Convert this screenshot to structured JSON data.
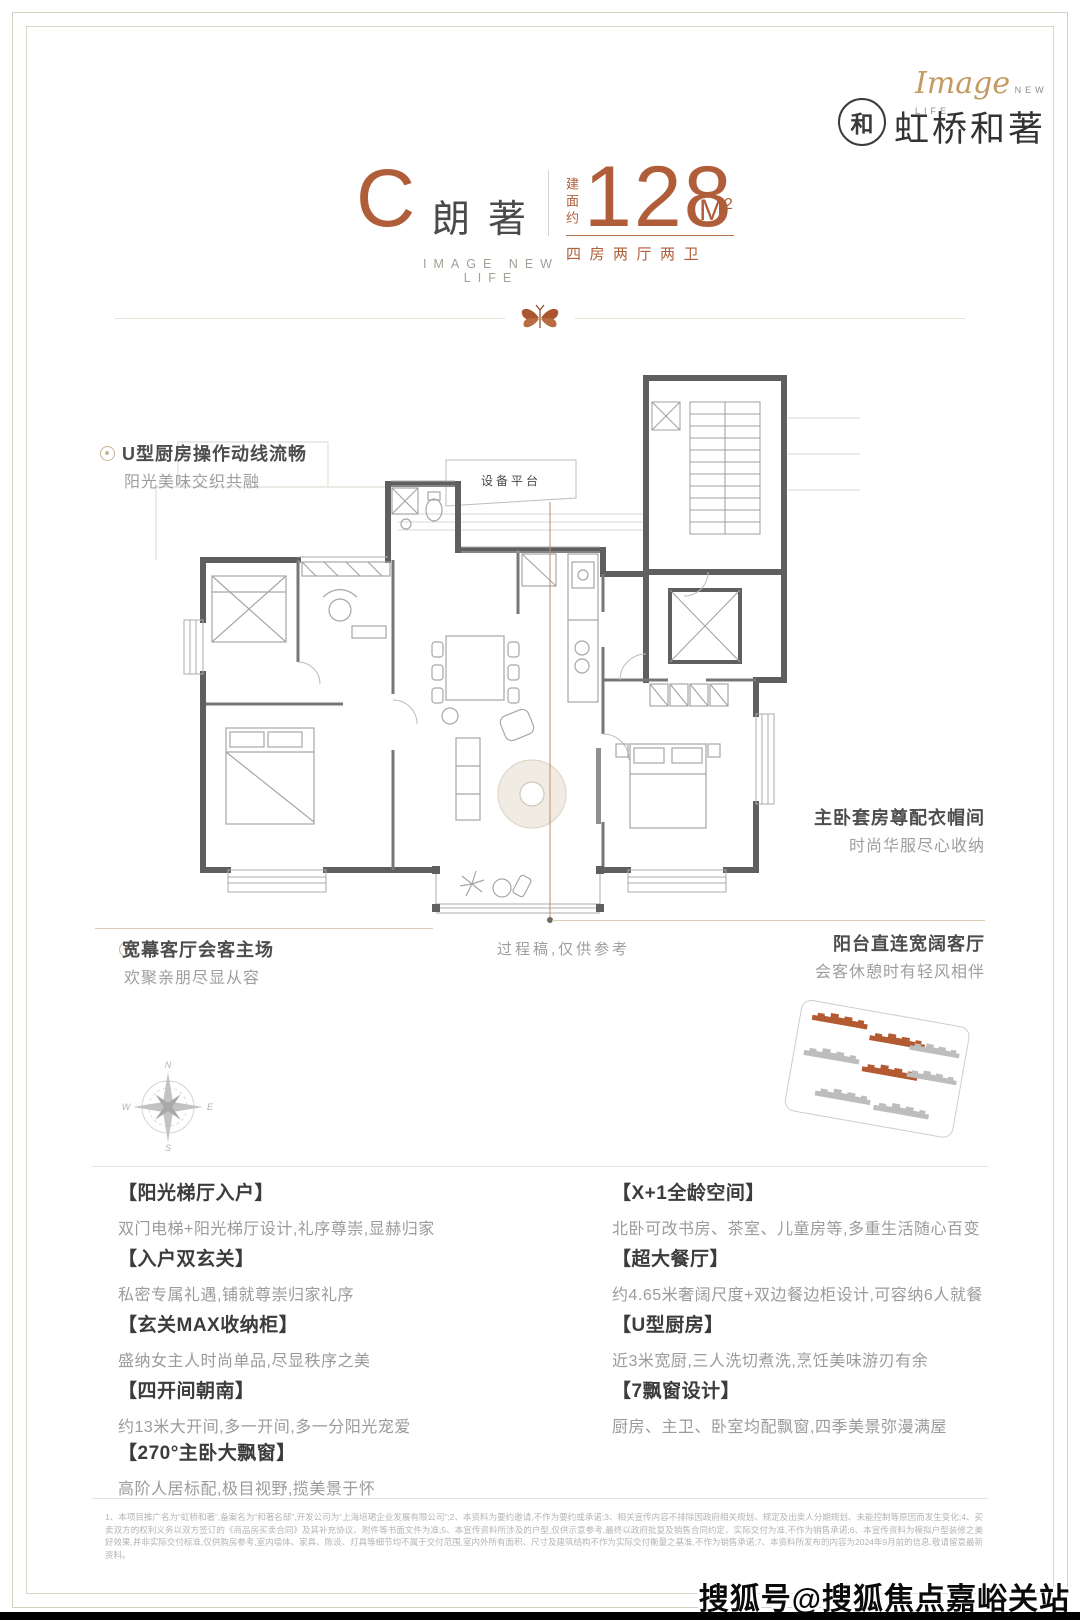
{
  "brand": {
    "script": "Image",
    "script_sub": "NEW LIFE",
    "badge": "和",
    "logo_text": "虹桥和著"
  },
  "header": {
    "unit_letter": "C",
    "unit_name": "朗著",
    "area_prefix": "建面约",
    "area_value": "128",
    "area_unit": "M",
    "area_unit_sup": "2",
    "layout": "四房两厅两卫",
    "tagline": "IMAGE NEW LIFE"
  },
  "plan": {
    "platform_label": "设备平台",
    "draft_note": "过程稿,仅供参考",
    "callouts": {
      "kitchen": {
        "title": "U型厨房操作动线流畅",
        "subtitle": "阳光美味交织共融"
      },
      "master": {
        "title": "主卧套房尊配衣帽间",
        "subtitle": "时尚华服尽心收纳"
      },
      "living": {
        "title": "宽幕客厅会客主场",
        "subtitle": "欢聚亲朋尽显从容"
      },
      "balcony": {
        "title": "阳台直连宽阔客厅",
        "subtitle": "会客休憩时有轻风相伴"
      }
    },
    "compass": {
      "n": "N",
      "e": "E",
      "s": "S",
      "w": "W"
    }
  },
  "features": {
    "left": [
      {
        "t": "【阳光梯厅入户】",
        "d": "双门电梯+阳光梯厅设计,礼序尊崇,显赫归家"
      },
      {
        "t": "【入户双玄关】",
        "d": "私密专属礼遇,铺就尊崇归家礼序"
      },
      {
        "t": "【玄关MAX收纳柜】",
        "d": "盛纳女主人时尚单品,尽显秩序之美"
      },
      {
        "t": "【四开间朝南】",
        "d": "约13米大开间,多一开间,多一分阳光宠爱"
      },
      {
        "t": "【270°主卧大飘窗】",
        "d": "高阶人居标配,极目视野,揽美景于怀"
      }
    ],
    "right": [
      {
        "t": "【X+1全龄空间】",
        "d": "北卧可改书房、茶室、儿童房等,多重生活随心百变"
      },
      {
        "t": "【超大餐厅】",
        "d": "约4.65米奢阔尺度+双边餐边柜设计,可容纳6人就餐"
      },
      {
        "t": "【U型厨房】",
        "d": "近3米宽厨,三人洗切煮洗,烹饪美味游刃有余"
      },
      {
        "t": "【7飘窗设计】",
        "d": "厨房、主卫、卧室均配飘窗,四季美景弥漫满屋"
      }
    ]
  },
  "footer": {
    "disclaimer": "1、本项目推广名为“虹桥和著”,备案名为“和著名邸”,开发公司为“上海培珺企业发展有限公司”;2、本资料为要约邀请,不作为要约或承诺;3、相关宣传内容不排除因政府相关规划、规定及出卖人分期规划、未能控制等原因而发生变化;4、买卖双方的权利义务以双方签订的《商品房买卖合同》及其补充协议、附件等书面文件为准;5、本宣传资料所涉及的户型,仅供示意参考,最终以政府批复及销售合同约定、实际交付为准,不作为销售承诺;6、本宣传资料为模拟户型装修之美好效果,并非实际交付标准,仅供购房参考,室内墙体、家具、陈设、灯具等细节均不属于交付范围,室内外所有面积、尺寸及建筑结构不作为实际交付衡量之基准,不作为销售承诺;7、本资料所发布的内容为2024年9月前的信息,敬请留意最新资料。",
    "watermark": "搜狐号@搜狐焦点嘉峪关站"
  },
  "colors": {
    "accent": "#b05d3a",
    "wall": "#5f5f5f",
    "leader_tan": "#ddcdb3",
    "leader_red": "#c98767",
    "site_orange": "#b45a32",
    "site_gray": "#bdbdbd"
  }
}
